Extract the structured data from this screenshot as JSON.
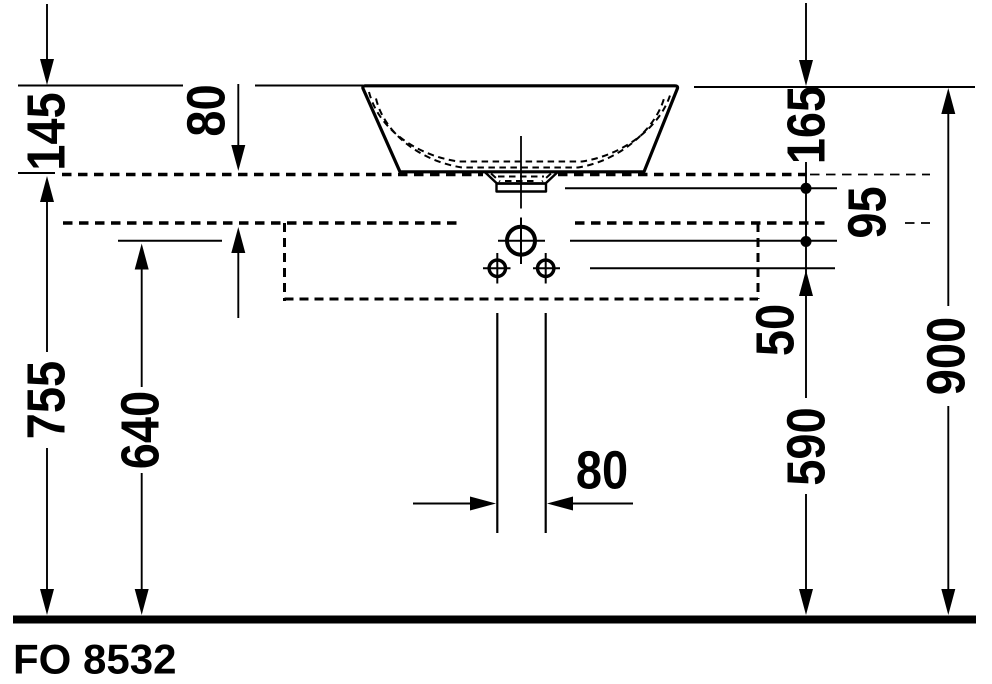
{
  "page": {
    "background": "#ffffff",
    "ink": "#000000"
  },
  "drawing": {
    "product_code": "FO 8532"
  },
  "dimension_labels": {
    "dim_145": "145",
    "dim_80_rim": "80",
    "dim_755": "755",
    "dim_640": "640",
    "dim_165": "165",
    "dim_95": "95",
    "dim_50": "50",
    "dim_590": "590",
    "dim_900": "900",
    "dim_80_pipe": "80"
  }
}
